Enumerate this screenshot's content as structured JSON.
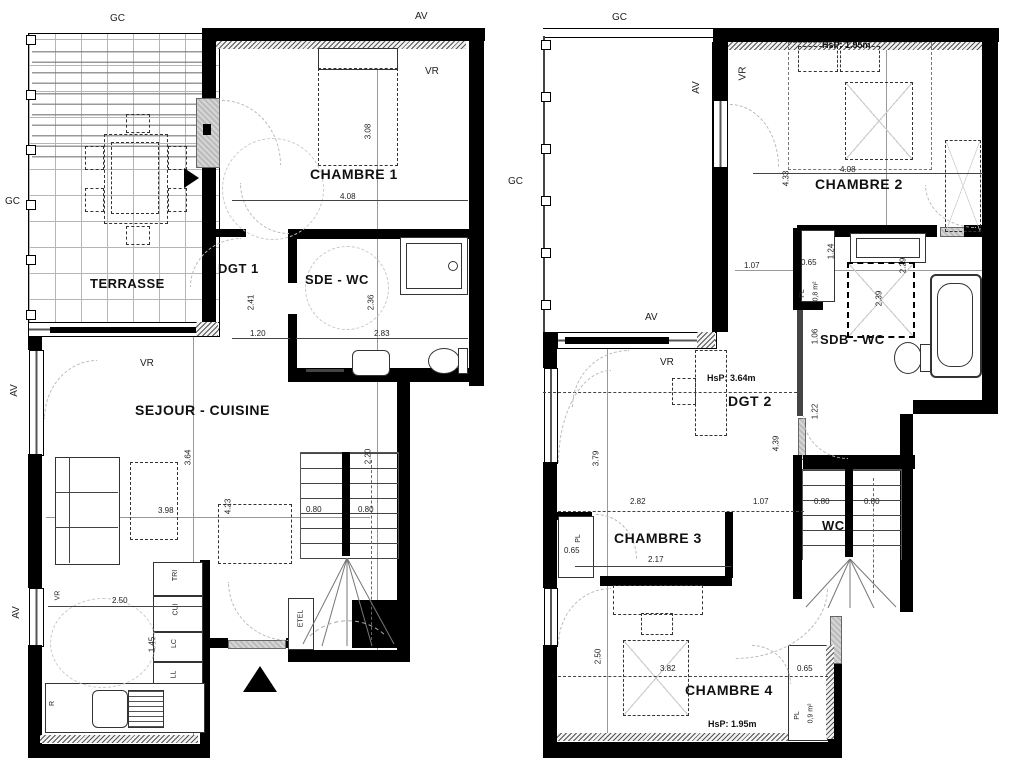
{
  "colors": {
    "ink": "#000000",
    "paper": "#ffffff",
    "hatch_grey": "#555555",
    "dash_grey": "#b9b9b9"
  },
  "left_plan": {
    "name": "lower-level-plan",
    "rooms": {
      "terrasse": "TERRASSE",
      "chambre1": "CHAMBRE 1",
      "dgt1": "DGT 1",
      "sde_wc": "SDE - WC",
      "sejour": "SEJOUR - CUISINE"
    },
    "annotations": {
      "gc_top": "GC",
      "av_top": "AV",
      "gc_left": "GC",
      "av_left_upper": "AV",
      "av_left_lower": "AV",
      "vr_chambre1": "VR",
      "vr_sejour": "VR",
      "vr_kitchen": "VR",
      "etel": "ETEL",
      "tri": "TRI",
      "cui": "CUI",
      "lc": "LC",
      "ll": "LL",
      "r": "R"
    },
    "dimensions": {
      "c1_w": "4.08",
      "c1_h": "3.08",
      "dgt1_h": "2.41",
      "dgt1_w": "1.20",
      "sde_h": "2.36",
      "sde_w": "2.83",
      "sej_h": "3.64",
      "sej_w": "3.98",
      "sej_d": "4.23",
      "kit_w": "2.50",
      "kit_h": "1.45",
      "stair_l": "0.80",
      "stair_r": "0.80",
      "stair_h": "2.20"
    }
  },
  "right_plan": {
    "name": "upper-level-plan",
    "rooms": {
      "chambre2": "CHAMBRE 2",
      "sdb_wc": "SDB - WC",
      "dgt2": "DGT 2",
      "chambre3": "CHAMBRE 3",
      "wc": "WC",
      "chambre4": "CHAMBRE 4"
    },
    "annotations": {
      "gc_top": "GC",
      "gc_left": "GC",
      "av_void": "AV",
      "vr_void": "VR",
      "av_dgt2": "AV",
      "vr_dgt2": "VR",
      "hsp_c2": "HsP: 1.95m",
      "hsp_dgt2": "HsP: 3.64m",
      "hsp_c4": "HsP: 1.95m",
      "pl_sdb": "PL",
      "pl_sdb_area": "0,8 m²",
      "pl_c3": "PL",
      "pl_c4": "PL",
      "pl_c4_area": "0,9 m²"
    },
    "dimensions": {
      "c2_w": "4.08",
      "c2_h": "4.33",
      "sdb_a": "0.65",
      "sdb_b": "1.24",
      "sdb_c": "2.39",
      "sdb_d": "2.29",
      "sdb_e": "1.06",
      "sdb_f": "1.22",
      "dgt2_a": "1.07",
      "dgt2_h": "4.39",
      "dgt2_b": "3.79",
      "c3_w": "2.82",
      "c3_b": "1.07",
      "c3_in": "2.17",
      "c3_pl": "0.65",
      "stair_l": "0.80",
      "stair_r": "0.80",
      "c4_w": "3.82",
      "c4_h": "2.50",
      "c4_pl": "0.65"
    }
  }
}
